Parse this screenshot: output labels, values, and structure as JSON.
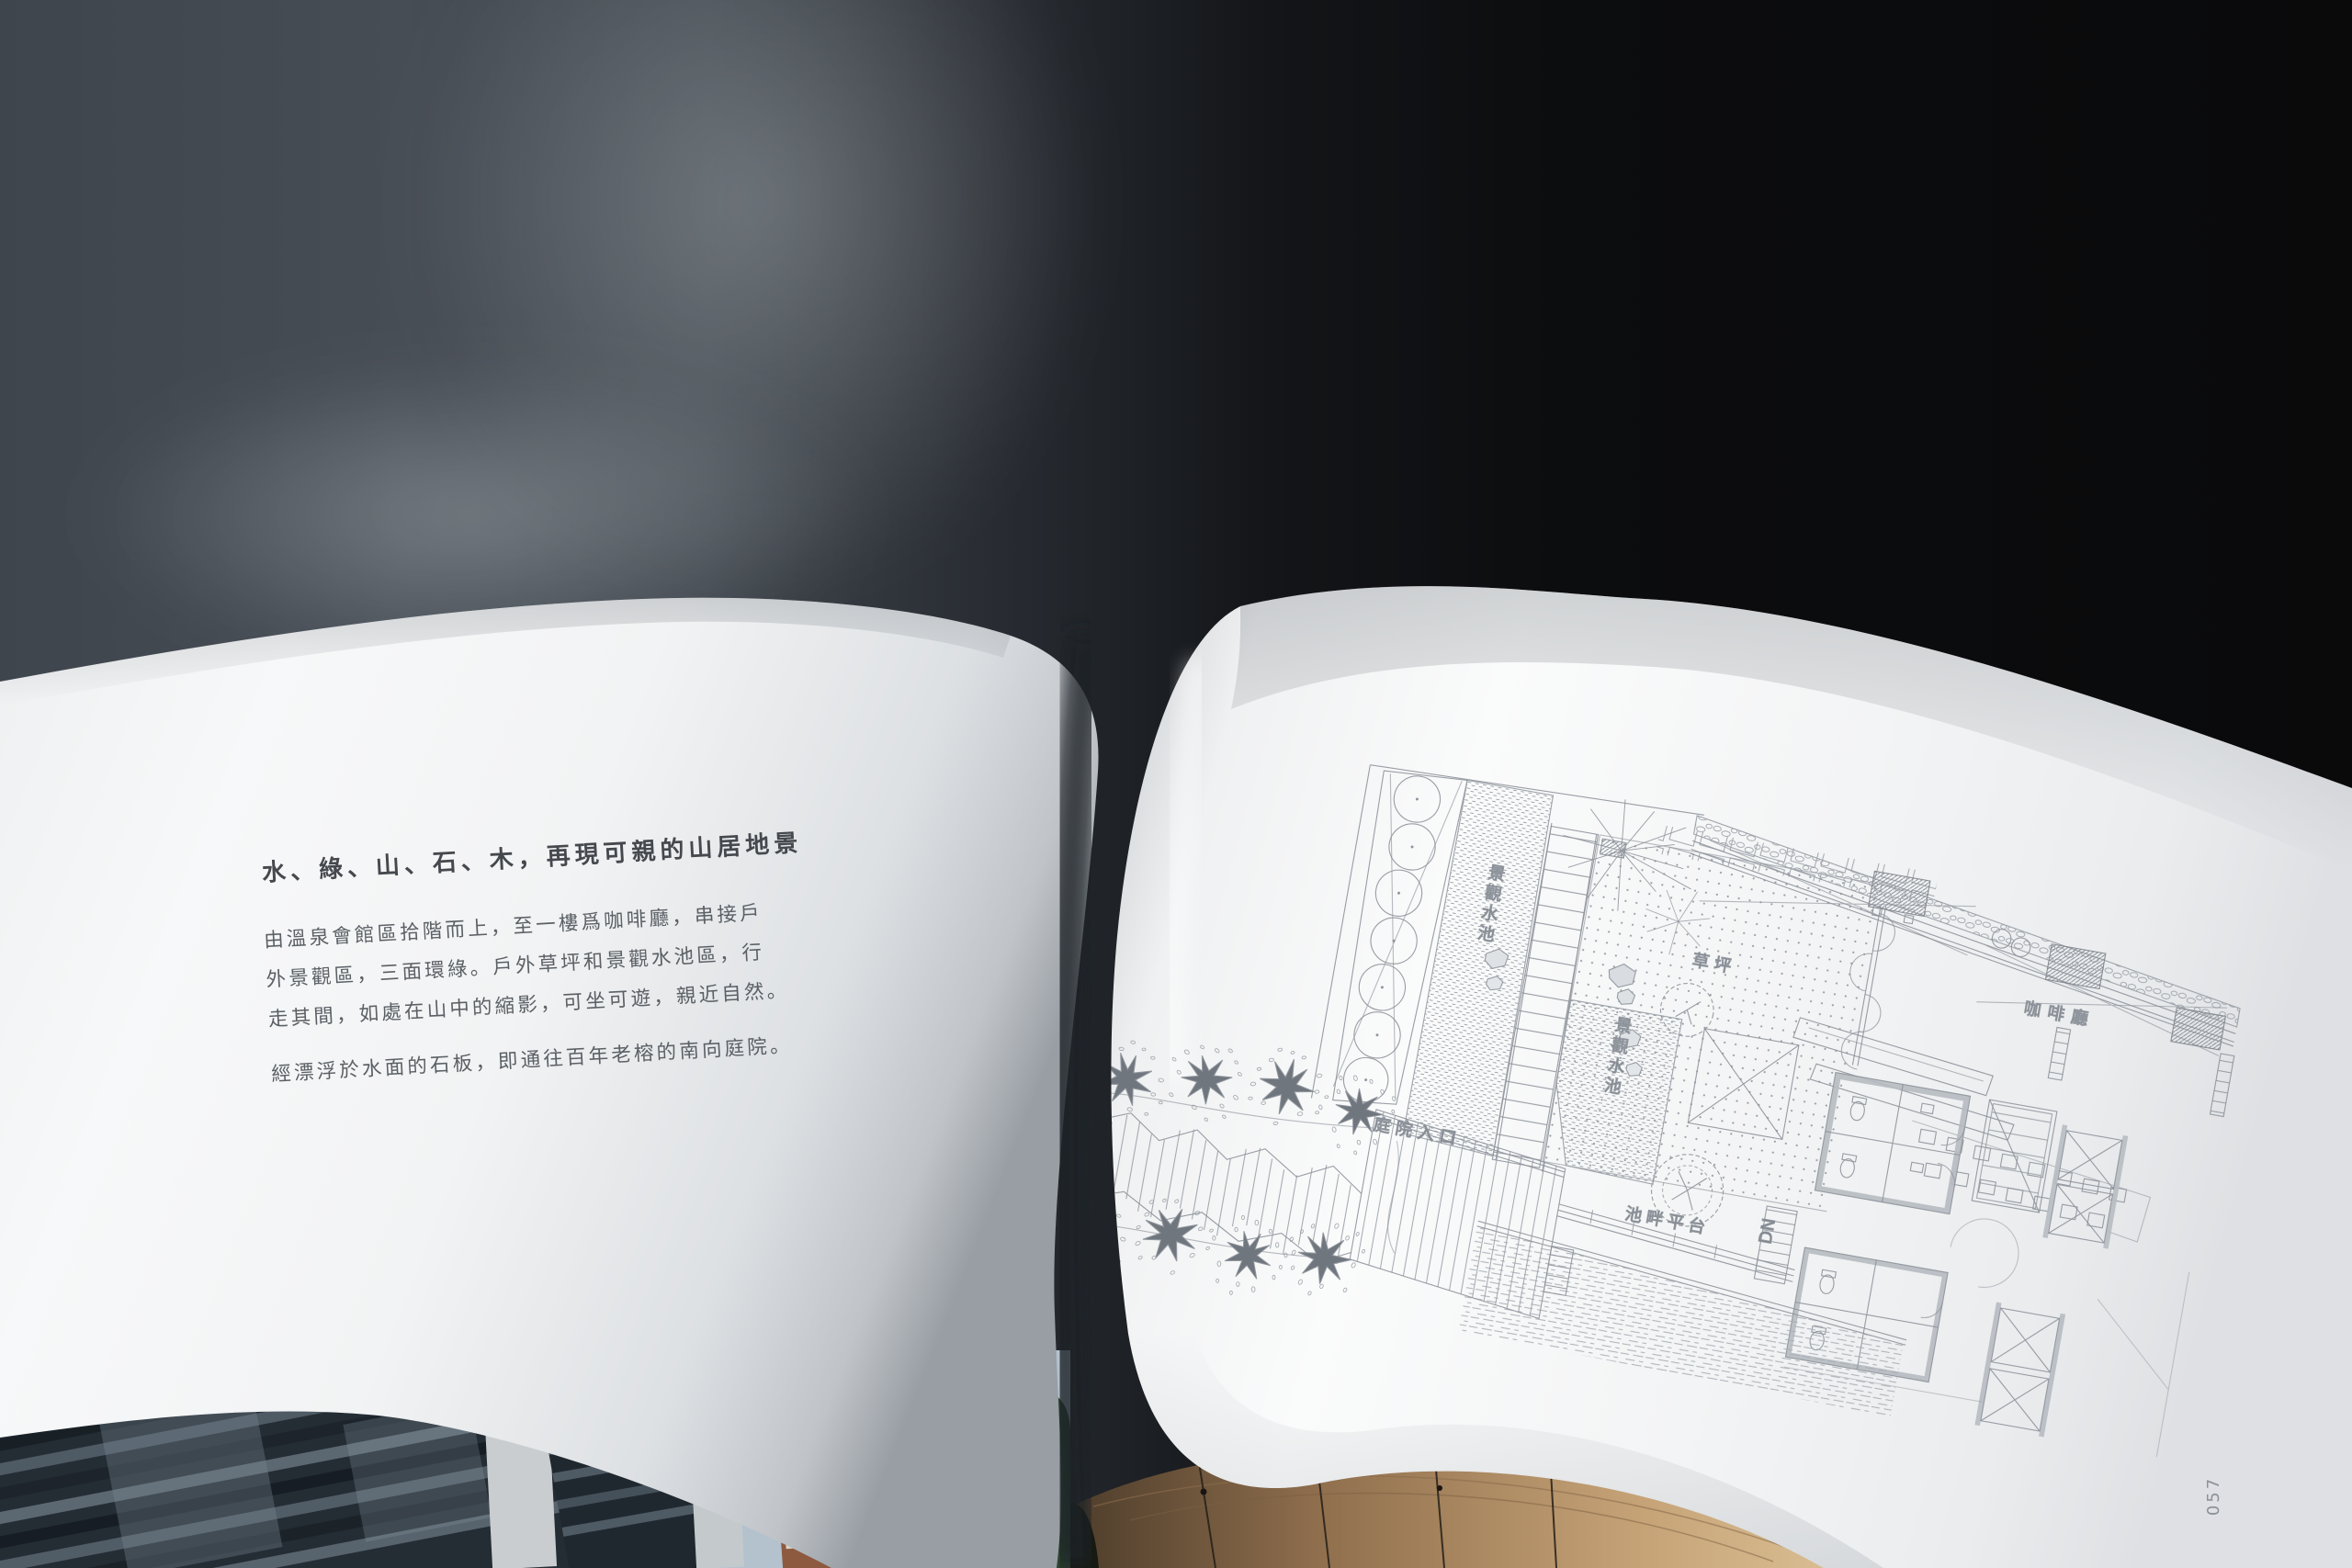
{
  "book": {
    "left_page": {
      "heading": "水、綠、山、石、木，再現可親的山居地景",
      "body_lines": [
        "由溫泉會館區拾階而上，至一樓爲咖啡廳，串接戶",
        "外景觀區，三面環綠。戶外草坪和景觀水池區，行",
        "走其間，如處在山中的縮影，可坐可遊，親近自然。"
      ],
      "body_paragraph2": "經漂浮於水面的石板，即通往百年老榕的南向庭院。"
    },
    "right_page": {
      "page_number": "057",
      "plan": {
        "label_water_pool_upper": "景觀水池",
        "label_lawn": "草坪",
        "label_cafe": "咖啡廳",
        "label_courtyard_entrance": "庭院入口",
        "label_water_pool_mid": "景觀水池",
        "label_poolside_platform": "池畔平台",
        "label_stair_down": "DN"
      }
    }
  },
  "colors": {
    "background_dark": "#0b0c0d",
    "background_slate": "#454b53",
    "page_white": "#f4f5f6",
    "plan_line": "#8e949b",
    "heading_text": "#45494e",
    "body_text": "#5b6065",
    "ceiling_wood": "#b08a5e",
    "sky": "#b3c2cd",
    "glass_tower": "#232b33",
    "brick_tower": "#8d5a40",
    "foliage": "#2c4630"
  }
}
